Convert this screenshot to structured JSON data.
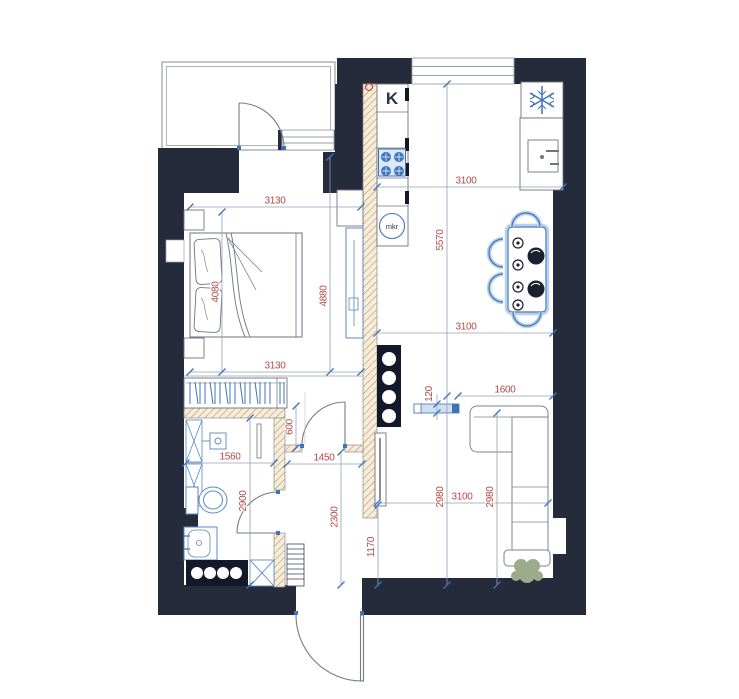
{
  "plan_title": "Apartment floor plan",
  "labels": {
    "kitchen": "K",
    "microwave": "mkr"
  },
  "dimensions": {
    "bedroom_width_top": "3130",
    "bedroom_width_bottom": "3130",
    "bedroom_depth_left": "4080",
    "bedroom_depth_right": "4880",
    "kitchen_width_top": "3100",
    "kitchen_width_middle": "3100",
    "living_width_bottom": "3100",
    "kitchen_living_depth": "5570",
    "living_depth_left": "2980",
    "living_depth_right": "2980",
    "media_unit_length": "1600",
    "media_unit_depth": "120",
    "hall_door_width": "600",
    "hallway_width": "1450",
    "bathroom_width": "1560",
    "bathroom_depth": "2900",
    "hallway_depth": "2300",
    "hallway_bottom_width": "1170"
  },
  "colors": {
    "wall": "#252b3a",
    "fixtures_blue": "#3f74bd",
    "dimension_red": "#b14a47",
    "hatch_brown": "#b98d5a",
    "furniture_gray": "#6e7480",
    "plant_green": "#9cab8c"
  },
  "icons": {
    "fridge": "snowflake-icon",
    "stove": "burner-grid-icon",
    "microwave": "mkr-circle-icon",
    "plant": "plant-icon"
  }
}
